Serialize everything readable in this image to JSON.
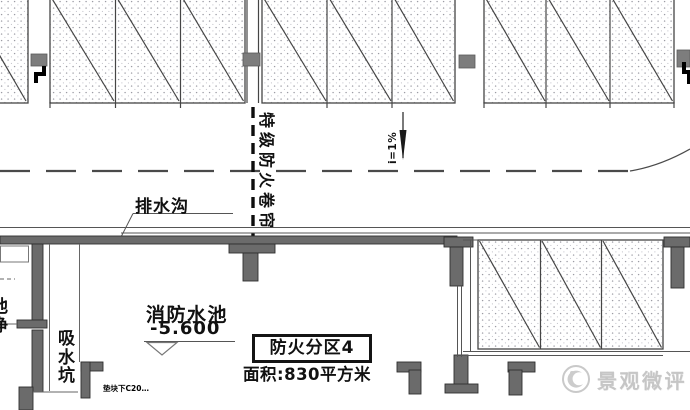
{
  "labels": {
    "fire_shutter": "特级防火卷帘",
    "slope": "i=1%",
    "drain_ditch": "排水沟",
    "fire_pool": "消防水池",
    "pool_elevation": "-5.600",
    "suction_pit": "吸水坑",
    "left_clipped": "池净",
    "bottom_note": "垫块下C20…",
    "fire_zone_name": "防火分区4",
    "fire_zone_area": "面积:830平方米"
  },
  "watermark": {
    "text": "景观微评"
  },
  "colors": {
    "wall_fill": "#6b6b6b",
    "line": "#454545",
    "column_marker": "#7d7d7d",
    "watermark_gray": "#c6c6c6",
    "stipple_dot": "#9b9ba4"
  }
}
